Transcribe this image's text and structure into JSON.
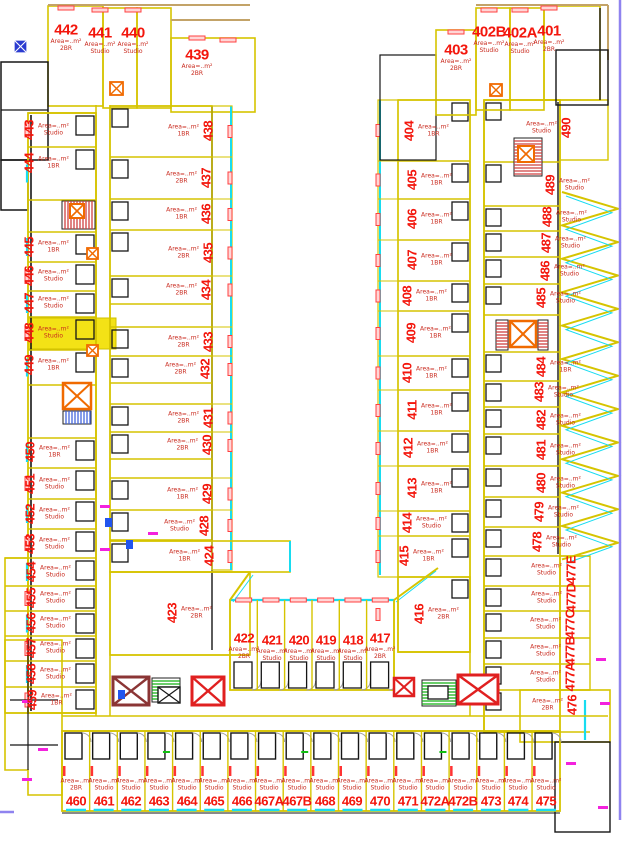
{
  "plan": {
    "title": "residential-floor-plan",
    "highlighted_unit": "448",
    "area_line": "Area=..m²",
    "colors": {
      "unit_number": "#f3160c",
      "unit_boundary": "#d6c400",
      "wall": "#161616",
      "balcony_edge": "#17dcf0",
      "window_marker": "#ff4040",
      "elevator": "#f06a00",
      "stairs_red": "#cf4040",
      "stairs_green": "#12b012",
      "highlight": "#f3e216",
      "page_border": "#8f83ef",
      "door_magenta": "#f322dd"
    },
    "unit_groups": [
      {
        "name": "top-left-row",
        "rot": 0,
        "side": "b",
        "font_px": 15,
        "units": [
          {
            "id": "442",
            "x": 66,
            "y": 30,
            "type": "2BR"
          },
          {
            "id": "441",
            "x": 100,
            "y": 33,
            "type": "Studio"
          },
          {
            "id": "440",
            "x": 133,
            "y": 33,
            "type": "Studio"
          },
          {
            "id": "439",
            "x": 197,
            "y": 55,
            "type": "2BR"
          }
        ]
      },
      {
        "name": "left-outer-column",
        "rot": 90,
        "side": "r",
        "font_px": 13,
        "units": [
          {
            "id": "443",
            "x": 29,
            "y": 130,
            "type": "Studio"
          },
          {
            "id": "444",
            "x": 29,
            "y": 163,
            "type": "1BR"
          },
          {
            "id": "445",
            "x": 29,
            "y": 247,
            "type": "1BR"
          },
          {
            "id": "446",
            "x": 29,
            "y": 276,
            "type": "Studio"
          },
          {
            "id": "447",
            "x": 29,
            "y": 303,
            "type": "Studio"
          },
          {
            "id": "448",
            "x": 29,
            "y": 333,
            "type": "Studio"
          },
          {
            "id": "449",
            "x": 29,
            "y": 365,
            "type": "1BR"
          },
          {
            "id": "450",
            "x": 30,
            "y": 452,
            "type": "1BR"
          },
          {
            "id": "451",
            "x": 30,
            "y": 484,
            "type": "Studio"
          },
          {
            "id": "452",
            "x": 30,
            "y": 514,
            "type": "Studio"
          },
          {
            "id": "453",
            "x": 30,
            "y": 544,
            "type": "Studio"
          },
          {
            "id": "454",
            "x": 31,
            "y": 572,
            "type": "Studio"
          },
          {
            "id": "455",
            "x": 31,
            "y": 598,
            "type": "Studio"
          },
          {
            "id": "456",
            "x": 31,
            "y": 623,
            "type": "Studio"
          },
          {
            "id": "457",
            "x": 31,
            "y": 648,
            "type": "Studio"
          },
          {
            "id": "458",
            "x": 31,
            "y": 674,
            "type": "Studio"
          },
          {
            "id": "459",
            "x": 32,
            "y": 700,
            "type": "1BR"
          }
        ]
      },
      {
        "name": "left-inner-column",
        "rot": 90,
        "side": "l",
        "font_px": 13,
        "units": [
          {
            "id": "438",
            "x": 208,
            "y": 131,
            "type": "1BR"
          },
          {
            "id": "437",
            "x": 206,
            "y": 178,
            "type": "2BR"
          },
          {
            "id": "436",
            "x": 206,
            "y": 214,
            "type": "1BR"
          },
          {
            "id": "435",
            "x": 208,
            "y": 253,
            "type": "2BR"
          },
          {
            "id": "434",
            "x": 206,
            "y": 290,
            "type": "2BR"
          },
          {
            "id": "433",
            "x": 208,
            "y": 342,
            "type": "2BR"
          },
          {
            "id": "432",
            "x": 205,
            "y": 369,
            "type": "2BR"
          },
          {
            "id": "431",
            "x": 208,
            "y": 418,
            "type": "2BR"
          },
          {
            "id": "430",
            "x": 207,
            "y": 445,
            "type": "2BR"
          },
          {
            "id": "429",
            "x": 207,
            "y": 494,
            "type": "1BR"
          },
          {
            "id": "428",
            "x": 204,
            "y": 526,
            "type": "Studio"
          },
          {
            "id": "424",
            "x": 209,
            "y": 556,
            "type": "1BR"
          },
          {
            "id": "423",
            "x": 172,
            "y": 613,
            "type": "2BR",
            "side": "r"
          }
        ]
      },
      {
        "name": "bottom-center-row",
        "rot": 0,
        "side": "b",
        "font_px": 13,
        "units": [
          {
            "id": "422",
            "x": 244,
            "y": 638,
            "type": "2BR"
          },
          {
            "id": "421",
            "x": 272,
            "y": 640,
            "type": "Studio"
          },
          {
            "id": "420",
            "x": 299,
            "y": 640,
            "type": "Studio"
          },
          {
            "id": "419",
            "x": 326,
            "y": 640,
            "type": "Studio"
          },
          {
            "id": "418",
            "x": 353,
            "y": 640,
            "type": "Studio"
          },
          {
            "id": "417",
            "x": 380,
            "y": 638,
            "type": "2BR"
          }
        ]
      },
      {
        "name": "right-inner-column",
        "rot": 90,
        "side": "r",
        "font_px": 13,
        "units": [
          {
            "id": "404",
            "x": 409,
            "y": 131,
            "type": "1BR"
          },
          {
            "id": "405",
            "x": 412,
            "y": 180,
            "type": "1BR"
          },
          {
            "id": "406",
            "x": 412,
            "y": 219,
            "type": "1BR"
          },
          {
            "id": "407",
            "x": 412,
            "y": 260,
            "type": "1BR"
          },
          {
            "id": "408",
            "x": 407,
            "y": 296,
            "type": "1BR"
          },
          {
            "id": "409",
            "x": 411,
            "y": 333,
            "type": "1BR"
          },
          {
            "id": "410",
            "x": 407,
            "y": 373,
            "type": "1BR"
          },
          {
            "id": "411",
            "x": 412,
            "y": 410,
            "type": "1BR"
          },
          {
            "id": "412",
            "x": 408,
            "y": 448,
            "type": "1BR"
          },
          {
            "id": "413",
            "x": 412,
            "y": 488,
            "type": "1BR"
          },
          {
            "id": "414",
            "x": 407,
            "y": 523,
            "type": "Studio"
          },
          {
            "id": "415",
            "x": 404,
            "y": 556,
            "type": "1BR"
          },
          {
            "id": "416",
            "x": 419,
            "y": 614,
            "type": "2BR"
          }
        ]
      },
      {
        "name": "bottom-row",
        "rot": 0,
        "side": "t",
        "font_px": 13,
        "units": [
          {
            "id": "460",
            "x": 76,
            "y": 801,
            "type": "2BR"
          },
          {
            "id": "461",
            "x": 104,
            "y": 801,
            "type": "Studio"
          },
          {
            "id": "462",
            "x": 131,
            "y": 801,
            "type": "Studio"
          },
          {
            "id": "463",
            "x": 159,
            "y": 801,
            "type": "Studio"
          },
          {
            "id": "464",
            "x": 187,
            "y": 801,
            "type": "Studio"
          },
          {
            "id": "465",
            "x": 214,
            "y": 801,
            "type": "Studio"
          },
          {
            "id": "466",
            "x": 242,
            "y": 801,
            "type": "Studio"
          },
          {
            "id": "467A",
            "x": 269,
            "y": 801,
            "type": "Studio"
          },
          {
            "id": "467B",
            "x": 297,
            "y": 801,
            "type": "Studio"
          },
          {
            "id": "468",
            "x": 325,
            "y": 801,
            "type": "Studio"
          },
          {
            "id": "469",
            "x": 352,
            "y": 801,
            "type": "Studio"
          },
          {
            "id": "470",
            "x": 380,
            "y": 801,
            "type": "Studio"
          },
          {
            "id": "471",
            "x": 408,
            "y": 801,
            "type": "Studio"
          },
          {
            "id": "472A",
            "x": 435,
            "y": 801,
            "type": "Studio"
          },
          {
            "id": "472B",
            "x": 463,
            "y": 801,
            "type": "Studio"
          },
          {
            "id": "473",
            "x": 491,
            "y": 801,
            "type": "Studio"
          },
          {
            "id": "474",
            "x": 518,
            "y": 801,
            "type": "Studio"
          },
          {
            "id": "475",
            "x": 546,
            "y": 801,
            "type": "Studio"
          }
        ]
      },
      {
        "name": "top-right-row",
        "rot": 0,
        "side": "b",
        "font_px": 15,
        "units": [
          {
            "id": "403",
            "x": 456,
            "y": 50,
            "type": "2BR"
          },
          {
            "id": "402B",
            "x": 489,
            "y": 32,
            "type": "Studio"
          },
          {
            "id": "402A",
            "x": 520,
            "y": 33,
            "type": "Studio"
          },
          {
            "id": "401",
            "x": 549,
            "y": 31,
            "type": "2BR"
          }
        ]
      },
      {
        "name": "right-outer-column",
        "rot": 90,
        "side": "r",
        "font_px": 13,
        "units": [
          {
            "id": "490",
            "x": 566,
            "y": 128,
            "type": "Studio",
            "side": "l"
          },
          {
            "id": "489",
            "x": 550,
            "y": 185,
            "type": "Studio"
          },
          {
            "id": "488",
            "x": 547,
            "y": 217,
            "type": "Studio"
          },
          {
            "id": "487",
            "x": 546,
            "y": 243,
            "type": "Studio"
          },
          {
            "id": "486",
            "x": 545,
            "y": 271,
            "type": "Studio"
          },
          {
            "id": "485",
            "x": 541,
            "y": 298,
            "type": "Studio"
          },
          {
            "id": "484",
            "x": 541,
            "y": 367,
            "type": "1BR"
          },
          {
            "id": "483",
            "x": 539,
            "y": 392,
            "type": "Studio"
          },
          {
            "id": "482",
            "x": 541,
            "y": 420,
            "type": "Studio"
          },
          {
            "id": "481",
            "x": 541,
            "y": 450,
            "type": "Studio"
          },
          {
            "id": "480",
            "x": 541,
            "y": 483,
            "type": "Studio"
          },
          {
            "id": "479",
            "x": 539,
            "y": 512,
            "type": "Studio"
          },
          {
            "id": "478",
            "x": 537,
            "y": 542,
            "type": "Studio"
          },
          {
            "id": "477E",
            "x": 571,
            "y": 570,
            "type": "Studio",
            "side": "l"
          },
          {
            "id": "477D",
            "x": 571,
            "y": 598,
            "type": "Studio",
            "side": "l"
          },
          {
            "id": "477C",
            "x": 570,
            "y": 624,
            "type": "Studio",
            "side": "l"
          },
          {
            "id": "477B",
            "x": 570,
            "y": 651,
            "type": "Studio",
            "side": "l"
          },
          {
            "id": "477A",
            "x": 570,
            "y": 677,
            "type": "Studio",
            "side": "l"
          },
          {
            "id": "476",
            "x": 572,
            "y": 705,
            "type": "2BR",
            "side": "l"
          }
        ]
      }
    ]
  }
}
